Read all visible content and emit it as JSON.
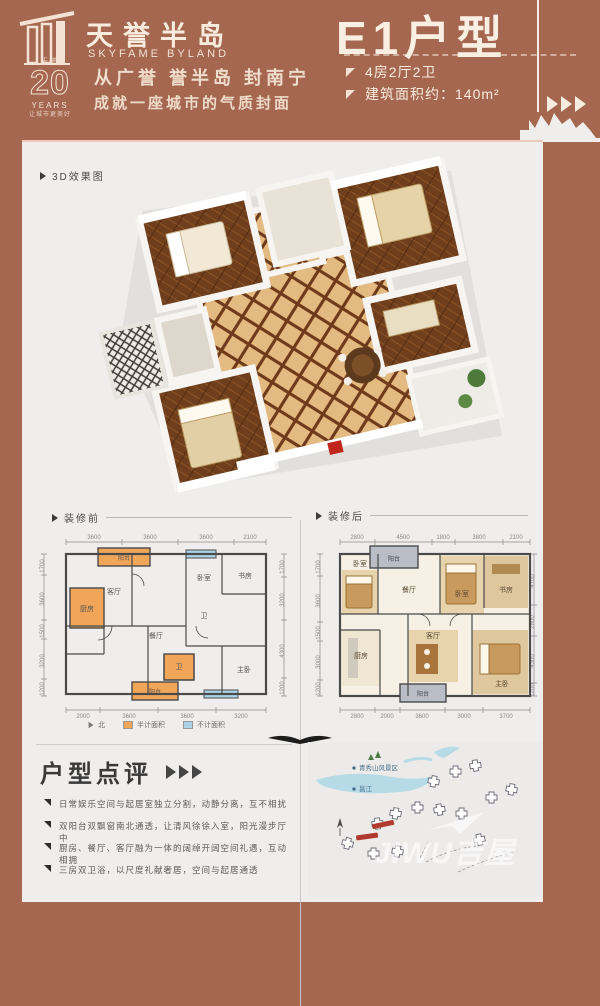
{
  "header": {
    "brand_cn": "天誉半岛",
    "brand_en": "SKYFAME BYLAND",
    "badge_top": "天誉",
    "badge_number": "20",
    "badge_years": "YEARS",
    "badge_tag": "让城市更美好",
    "slogan_line1": "从广誉 誉半岛 封南宁",
    "slogan_line2": "成就一座城市的气质封面",
    "unit_title": "E1户型",
    "spec1": "4房2厅2卫",
    "spec2": "建筑面积约：140m²"
  },
  "labels": {
    "render3d": "3D效果图",
    "before": "装修前",
    "after": "装修后",
    "review_title": "户型点评"
  },
  "review_points": [
    "日常娱乐空间与起居室独立分割，动静分离，互不相扰",
    "双阳台双飘窗南北通透，让清风徐徐入室，阳光漫步厅中",
    "厨房、餐厅、客厅融为一体的阔绰开阔空间礼遇，互动相拥",
    "三房双卫浴，以尺度礼献奢居，空间与起居通透"
  ],
  "plan_before": {
    "dims_top": [
      "3600",
      "3600",
      "3600",
      "2100"
    ],
    "dims_bottom": [
      "2000",
      "3600",
      "3600",
      "3200"
    ],
    "dims_left": [
      "1700",
      "3600",
      "1500",
      "3200",
      "1200"
    ],
    "dims_right": [
      "1700",
      "3200",
      "4300",
      "1200"
    ],
    "rooms": {
      "living": "客厅",
      "dining": "餐厅",
      "kitchen": "厨房",
      "bed": "卧室",
      "study": "书房",
      "master": "主卧",
      "bath1": "卫",
      "bath2": "卫",
      "balcony_top": "阳台",
      "balcony_bottom": "阳台"
    },
    "legend_north": "北",
    "legend_half": "半计面积",
    "legend_none": "不计面积"
  },
  "plan_after": {
    "dims_top": [
      "2800",
      "4500",
      "1800",
      "3800",
      "2100"
    ],
    "dims_bottom": [
      "2800",
      "2000",
      "3600",
      "3000",
      "3700"
    ],
    "dims_left": [
      "1700",
      "3600",
      "1500",
      "3000",
      "1200"
    ],
    "dims_right": [
      "4700",
      "2800",
      "4300",
      "1200"
    ],
    "rooms": {
      "bed1": "卧室",
      "dining": "餐厅",
      "bed2": "卧室",
      "study": "书房",
      "kitchen": "厨房",
      "living": "客厅",
      "master": "主卧",
      "balcony_top": "阳台",
      "balcony_bottom": "阳台"
    }
  },
  "map": {
    "scenic_label": "青秀山风景区",
    "river_label": "邕江",
    "watermark": "JIWU吉屋"
  }
}
